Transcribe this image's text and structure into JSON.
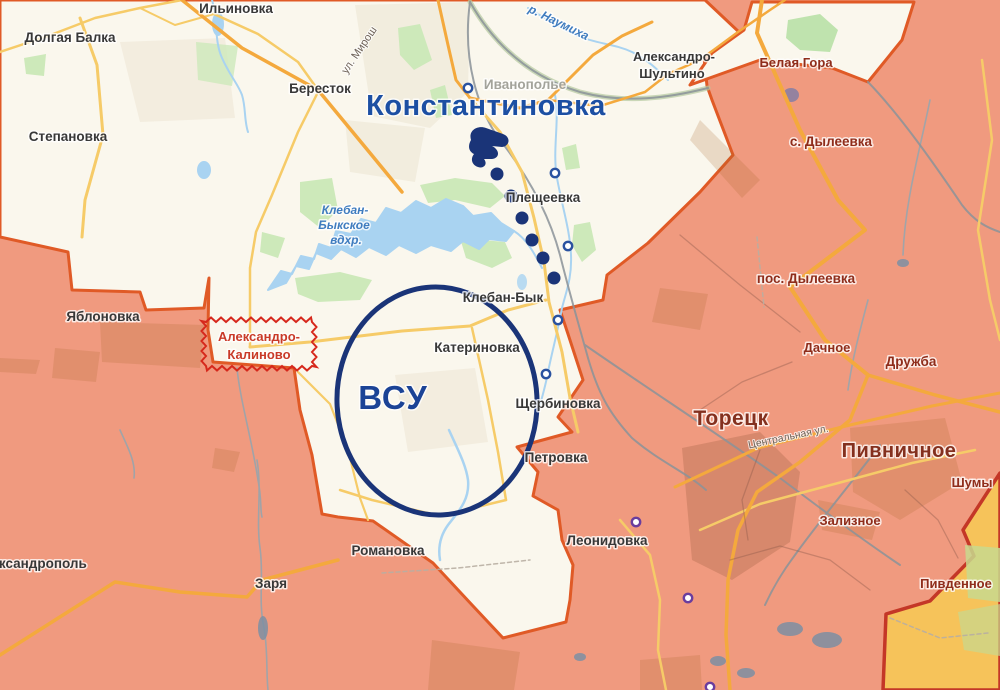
{
  "map": {
    "overlay": {
      "main_city_label": {
        "text": "Константиновка",
        "x": 486,
        "y": 115,
        "size": 29
      },
      "unit_label": {
        "text": "ВСУ",
        "x": 393,
        "y": 409,
        "size": 33
      },
      "ellipse": {
        "cx": 437,
        "cy": 401,
        "rx": 100,
        "ry": 114,
        "rotate": -3
      },
      "advance_dots": [
        [
          497,
          174
        ],
        [
          511,
          196
        ],
        [
          522,
          218
        ],
        [
          532,
          240
        ],
        [
          543,
          258
        ],
        [
          554,
          278
        ]
      ],
      "dot_radius": 6.5,
      "color": "#1A3478"
    },
    "settlement_rings": {
      "blue": [
        [
          468,
          88
        ],
        [
          555,
          173
        ],
        [
          568,
          246
        ],
        [
          558,
          320
        ],
        [
          546,
          374
        ]
      ],
      "violet": [
        [
          636,
          522
        ],
        [
          688,
          598
        ],
        [
          710,
          687
        ]
      ],
      "blue_color": "#2A52A0",
      "violet_color": "#6A3D9E"
    },
    "highlight": {
      "lines": [
        "Александро-",
        "Калиново"
      ],
      "x": 259,
      "y1": 341,
      "y2": 359,
      "size": 13,
      "box": {
        "x": 206,
        "y": 322,
        "w": 106,
        "h": 44
      },
      "zigzag_color": "#D6281C"
    },
    "labels": [
      {
        "t": "Ильиновка",
        "x": 236,
        "y": 13,
        "s": 13.5,
        "c": "town"
      },
      {
        "t": "Долгая Балка",
        "x": 70,
        "y": 42,
        "s": 13.5,
        "c": "town"
      },
      {
        "t": "Бересток",
        "x": 320,
        "y": 93,
        "s": 13.5,
        "c": "town"
      },
      {
        "t": "Степановка",
        "x": 68,
        "y": 141,
        "s": 13.5,
        "c": "town"
      },
      {
        "t": "Яблоновка",
        "x": 103,
        "y": 321,
        "s": 13.5,
        "c": "town"
      },
      {
        "t": "Плещеевка",
        "x": 543,
        "y": 202,
        "s": 13.5,
        "c": "town"
      },
      {
        "t": "Клебан-Бык",
        "x": 503,
        "y": 302,
        "s": 13.5,
        "c": "town"
      },
      {
        "t": "Катериновка",
        "x": 477,
        "y": 352,
        "s": 13.5,
        "c": "town"
      },
      {
        "t": "Щербиновка",
        "x": 558,
        "y": 408,
        "s": 13.5,
        "c": "town"
      },
      {
        "t": "Петровка",
        "x": 556,
        "y": 462,
        "s": 13.5,
        "c": "town"
      },
      {
        "t": "Романовка",
        "x": 388,
        "y": 555,
        "s": 13.5,
        "c": "town"
      },
      {
        "t": "Заря",
        "x": 271,
        "y": 588,
        "s": 13.5,
        "c": "town"
      },
      {
        "t": "Александрополь",
        "x": 30,
        "y": 568,
        "s": 13.5,
        "c": "town"
      },
      {
        "t": "Леонидовка",
        "x": 607,
        "y": 545,
        "s": 13.5,
        "c": "town"
      },
      {
        "t": "Александро-",
        "x": 674,
        "y": 61,
        "s": 13,
        "c": "town"
      },
      {
        "t": "Шультино",
        "x": 672,
        "y": 78,
        "s": 13,
        "c": "town"
      },
      {
        "t": "Белая Гора",
        "x": 796,
        "y": 67,
        "s": 13,
        "c": "town-red"
      },
      {
        "t": "с. Дылеевка",
        "x": 831,
        "y": 146,
        "s": 13.5,
        "c": "town-red"
      },
      {
        "t": "пос. Дылеевка",
        "x": 806,
        "y": 283,
        "s": 13.5,
        "c": "town-red"
      },
      {
        "t": "Дачное",
        "x": 827,
        "y": 352,
        "s": 13,
        "c": "town-red"
      },
      {
        "t": "Дружба",
        "x": 911,
        "y": 366,
        "s": 13.5,
        "c": "town-red"
      },
      {
        "t": "Торецк",
        "x": 731,
        "y": 425,
        "s": 21,
        "c": "city-red"
      },
      {
        "t": "Пивничное",
        "x": 899,
        "y": 457,
        "s": 20,
        "c": "city-red"
      },
      {
        "t": "Шумы",
        "x": 972,
        "y": 487,
        "s": 13,
        "c": "town-red"
      },
      {
        "t": "Зализное",
        "x": 850,
        "y": 525,
        "s": 13,
        "c": "town-red"
      },
      {
        "t": "Пивденное",
        "x": 956,
        "y": 588,
        "s": 13,
        "c": "town-red"
      },
      {
        "t": "Клебан-",
        "x": 345,
        "y": 214,
        "s": 12,
        "c": "water"
      },
      {
        "t": "Быкское",
        "x": 344,
        "y": 229,
        "s": 12,
        "c": "water"
      },
      {
        "t": "вдхр.",
        "x": 346,
        "y": 244,
        "s": 12,
        "c": "water"
      },
      {
        "t": "р. Наумиха",
        "x": 557,
        "y": 26,
        "s": 12,
        "c": "water",
        "r": 26
      },
      {
        "t": "Иванополье",
        "x": 525,
        "y": 89,
        "s": 13.5,
        "c": "gray"
      },
      {
        "t": "ул. Мирош",
        "x": 362,
        "y": 52,
        "s": 11,
        "c": "street",
        "r": -56
      },
      {
        "t": "Центральная ул.",
        "x": 789,
        "y": 440,
        "s": 10.5,
        "c": "street",
        "r": -12
      }
    ],
    "colors": {
      "free_zone": "#FAF7ED",
      "occupied_zone": "#F09A7F",
      "occupied_border": "#E05A26",
      "annexed_zone": "#F6C35A",
      "annexed_border": "#C43727",
      "water": "#A9D3F1",
      "forest": "#CDE9BA",
      "road_major": "#F4A93D",
      "road_minor": "#F6CB68",
      "railway": "#8B9399",
      "overlay_navy": "#1A3478"
    }
  }
}
